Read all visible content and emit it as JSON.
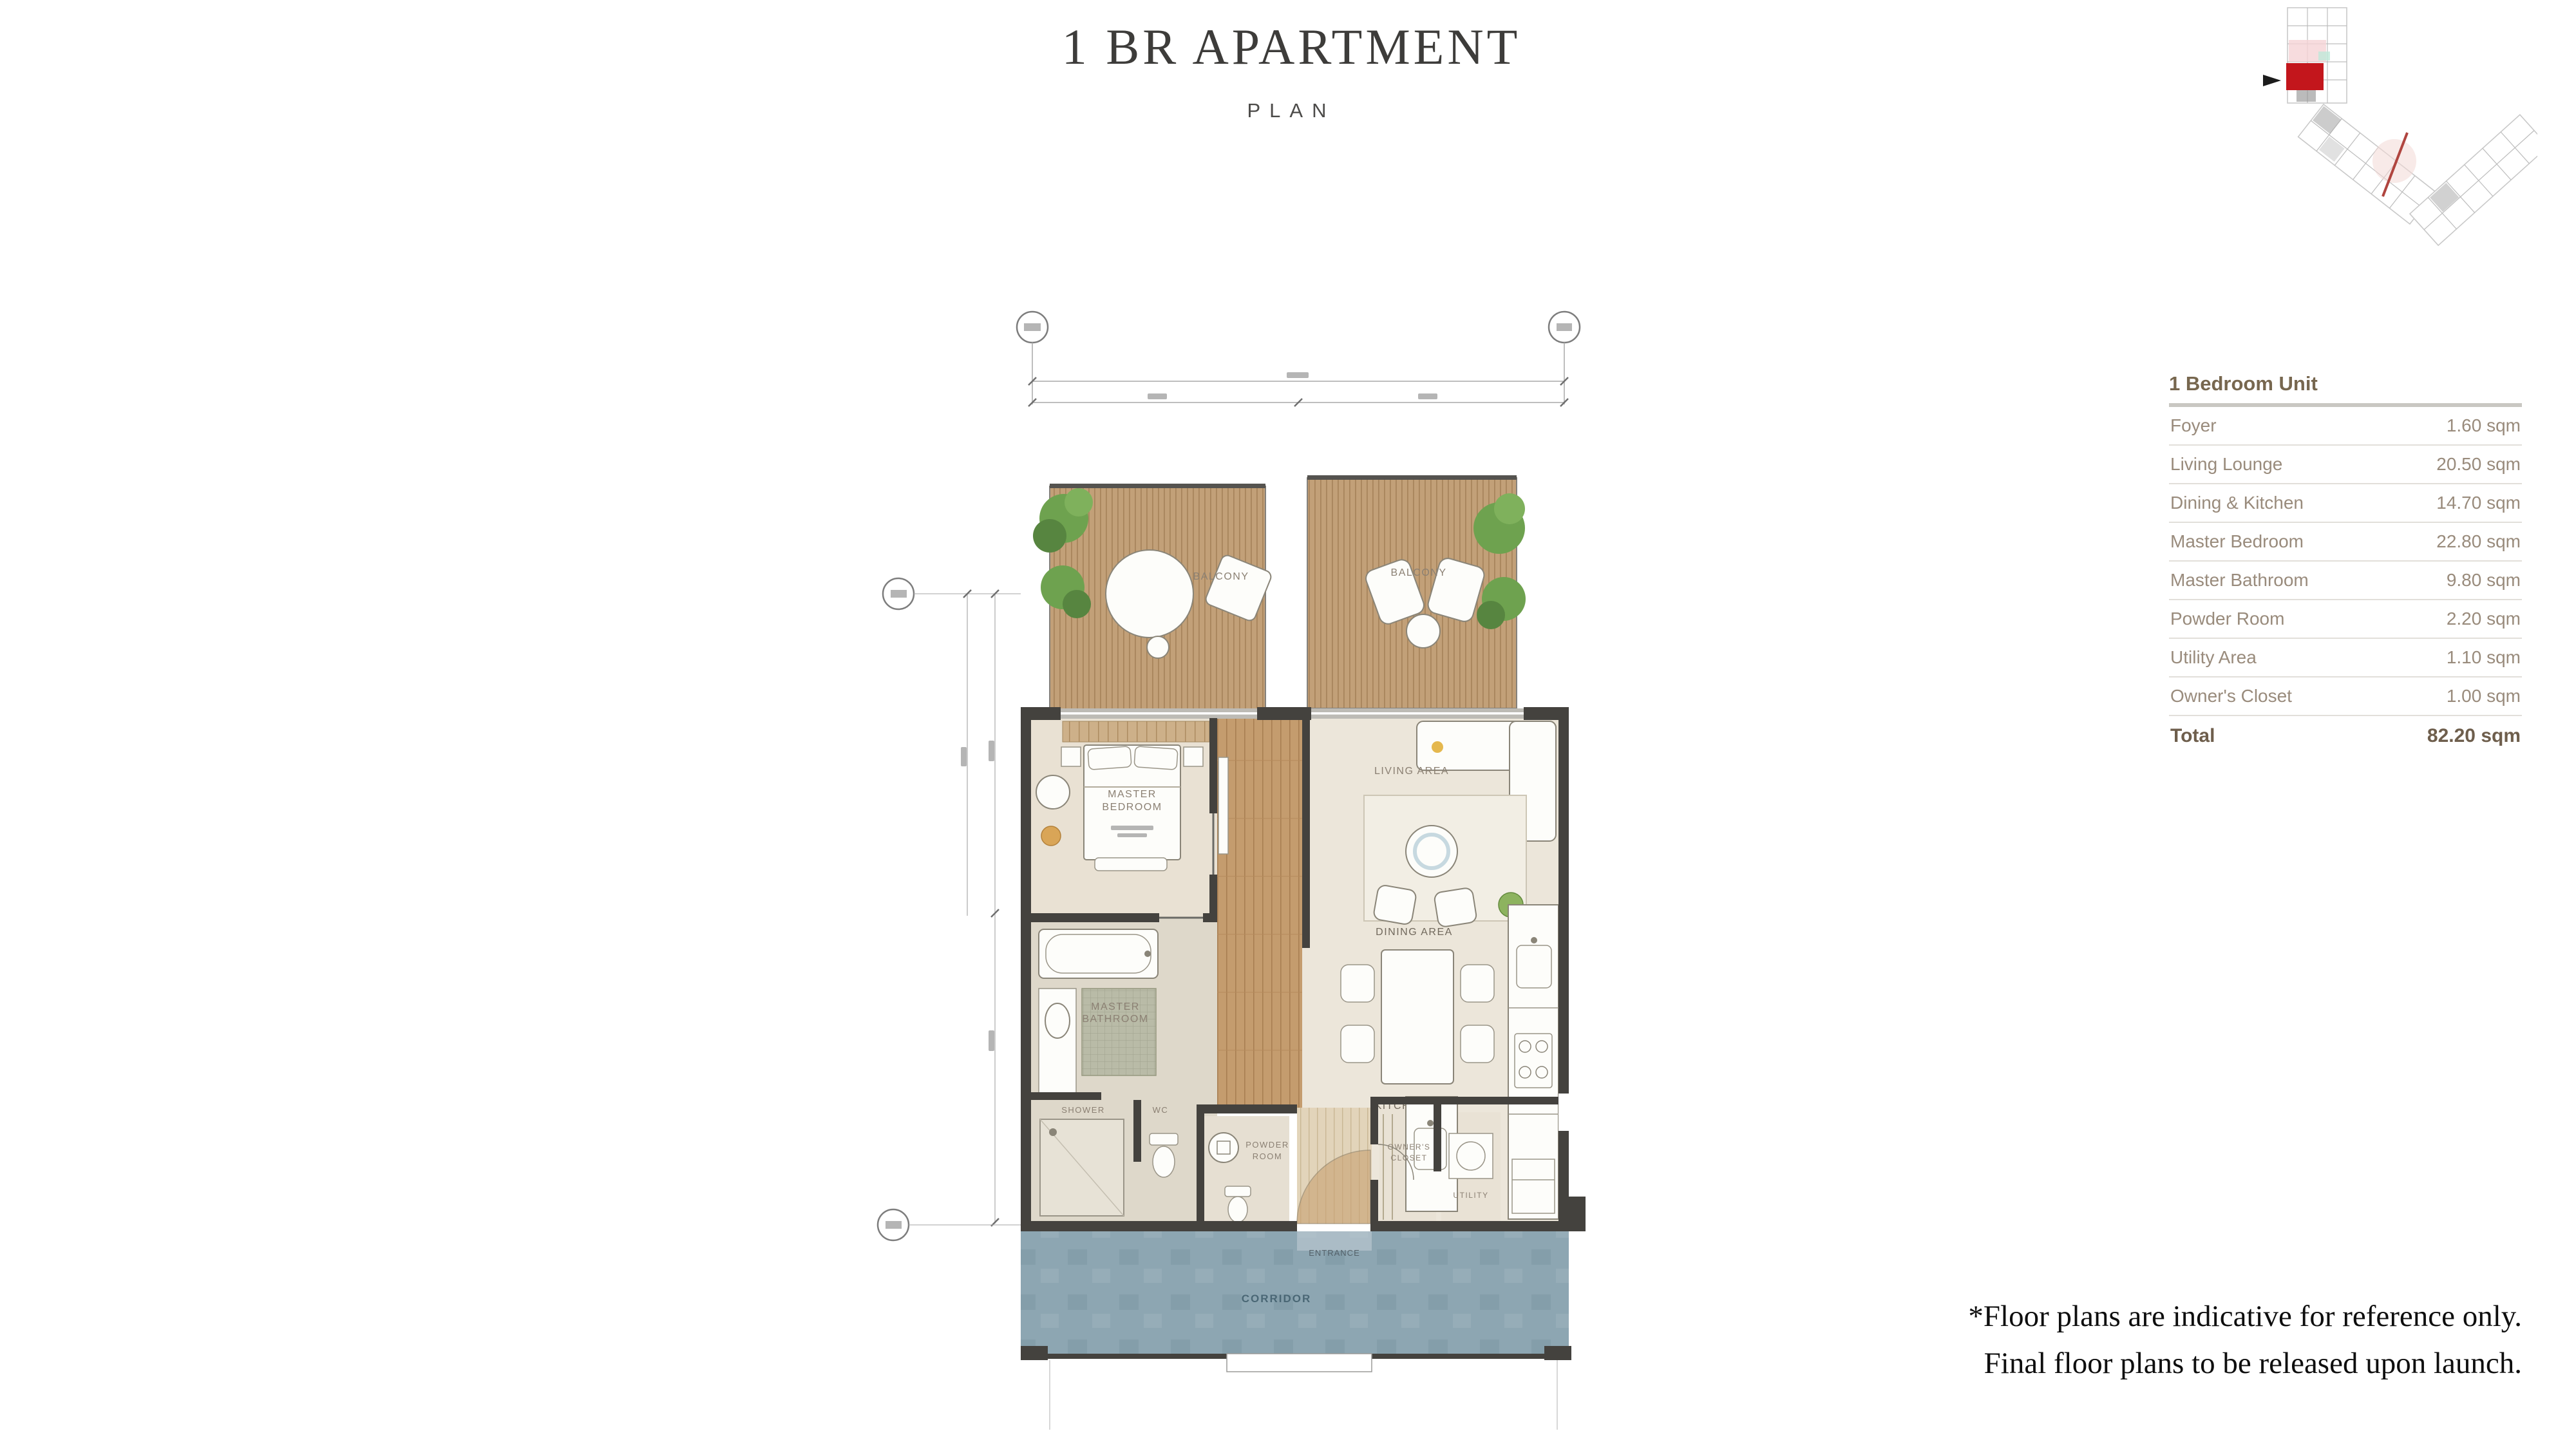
{
  "header": {
    "title": "1 BR APARTMENT",
    "subtitle": "PLAN"
  },
  "area_table": {
    "title": "1 Bedroom Unit",
    "rows": [
      {
        "label": "Foyer",
        "value": "1.60 sqm"
      },
      {
        "label": "Living Lounge",
        "value": "20.50 sqm"
      },
      {
        "label": "Dining & Kitchen",
        "value": "14.70 sqm"
      },
      {
        "label": "Master Bedroom",
        "value": "22.80 sqm"
      },
      {
        "label": "Master Bathroom",
        "value": "9.80 sqm"
      },
      {
        "label": "Powder Room",
        "value": "2.20 sqm"
      },
      {
        "label": "Utility Area",
        "value": "1.10 sqm"
      },
      {
        "label": "Owner's Closet",
        "value": "1.00 sqm"
      }
    ],
    "total_label": "Total",
    "total_value": "82.20 sqm"
  },
  "floor_plan": {
    "labels": {
      "balcony_left": "BALCONY",
      "balcony_right": "BALCONY",
      "master_bedroom_l1": "MASTER",
      "master_bedroom_l2": "BEDROOM",
      "living_area": "LIVING AREA",
      "dining_area": "DINING AREA",
      "kitchen": "KITCHEN",
      "master_bathroom_l1": "MASTER",
      "master_bathroom_l2": "BATHROOM",
      "shower": "SHOWER",
      "wc": "WC",
      "powder_l1": "POWDER",
      "powder_l2": "ROOM",
      "owners_closet_l1": "OWNER'S",
      "owners_closet_l2": "CLOSET",
      "utility": "UTILITY",
      "entrance": "ENTRANCE",
      "corridor": "CORRIDOR"
    }
  },
  "key_map": {
    "highlight_color": "#c3161c"
  },
  "disclaimer": {
    "line1": "*Floor plans are indicative for reference only.",
    "line2": "Final floor plans to be released upon launch."
  },
  "colors": {
    "wall": "#44423e",
    "deck_wood": "#c2a078",
    "corridor_wood": "#c49c6e",
    "floor_beige": "#ece6da",
    "bedroom_floor": "#e9e1d3",
    "bathroom_floor": "#ded8ca",
    "corridor_blue": "#8da6b2",
    "plant_green": "#6ea24f",
    "keymap_red": "#c3161c",
    "table_text": "#998b7c",
    "table_header": "#77674f"
  }
}
